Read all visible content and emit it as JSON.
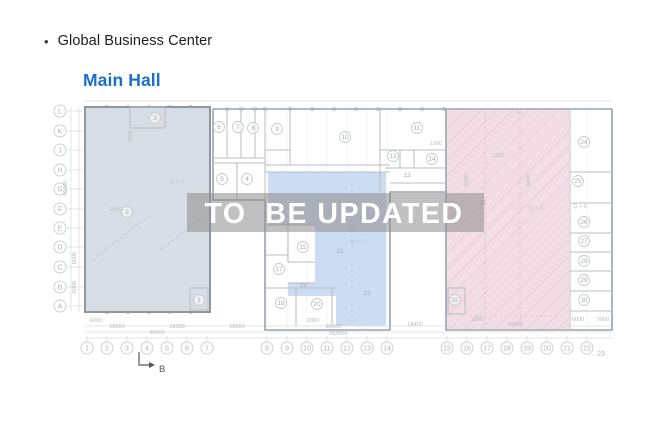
{
  "header": {
    "bullet": "•",
    "title": "Global Business Center",
    "subtitle": "Main Hall"
  },
  "watermark": {
    "text": "TO  BE UPDATED"
  },
  "colors": {
    "accent_blue": "#1a6fc7",
    "zone_left": "#d7dde4",
    "zone_middle": "#ccdcf2",
    "zone_right": "#f3dde4",
    "watermark_band": "rgba(141,141,141,0.55)",
    "watermark_text": "#ffffff"
  },
  "plan": {
    "section_marker": "B",
    "row_axes": [
      {
        "label": "L",
        "y": 111
      },
      {
        "label": "K",
        "y": 131
      },
      {
        "label": "J",
        "y": 150
      },
      {
        "label": "H",
        "y": 170
      },
      {
        "label": "G",
        "y": 189
      },
      {
        "label": "F",
        "y": 209
      },
      {
        "label": "E",
        "y": 228
      },
      {
        "label": "D",
        "y": 247
      },
      {
        "label": "C",
        "y": 267
      },
      {
        "label": "B",
        "y": 287
      },
      {
        "label": "A",
        "y": 306
      }
    ],
    "col_axes": [
      {
        "label": "1",
        "x": 87
      },
      {
        "label": "2",
        "x": 107
      },
      {
        "label": "3",
        "x": 127
      },
      {
        "label": "4",
        "x": 147
      },
      {
        "label": "5",
        "x": 167
      },
      {
        "label": "6",
        "x": 187
      },
      {
        "label": "7",
        "x": 207
      },
      {
        "label": "8",
        "x": 267
      },
      {
        "label": "9",
        "x": 287
      },
      {
        "label": "10",
        "x": 307
      },
      {
        "label": "11",
        "x": 327
      },
      {
        "label": "12",
        "x": 347
      },
      {
        "label": "13",
        "x": 367
      },
      {
        "label": "14",
        "x": 387
      },
      {
        "label": "15",
        "x": 447
      },
      {
        "label": "16",
        "x": 467
      },
      {
        "label": "17",
        "x": 487
      },
      {
        "label": "18",
        "x": 507
      },
      {
        "label": "19",
        "x": 527
      },
      {
        "label": "20",
        "x": 547
      },
      {
        "label": "21",
        "x": 567
      },
      {
        "label": "22",
        "x": 587
      },
      {
        "label": "23",
        "x": 601,
        "plain": true
      }
    ],
    "rooms": [
      {
        "n": "1",
        "x": 199,
        "y": 300
      },
      {
        "n": "2",
        "x": 127,
        "y": 212
      },
      {
        "n": "3",
        "x": 155,
        "y": 118
      },
      {
        "n": "4",
        "x": 247,
        "y": 179
      },
      {
        "n": "5",
        "x": 222,
        "y": 179
      },
      {
        "n": "6",
        "x": 219,
        "y": 127
      },
      {
        "n": "7",
        "x": 238,
        "y": 127
      },
      {
        "n": "8",
        "x": 253,
        "y": 128
      },
      {
        "n": "9",
        "x": 277,
        "y": 129
      },
      {
        "n": "10",
        "x": 345,
        "y": 137
      },
      {
        "n": "11",
        "x": 417,
        "y": 128
      },
      {
        "n": "12",
        "x": 393,
        "y": 156
      },
      {
        "n": "13",
        "x": 407,
        "y": 175,
        "plain": true
      },
      {
        "n": "14",
        "x": 432,
        "y": 159
      },
      {
        "n": "15",
        "x": 303,
        "y": 247
      },
      {
        "n": "17",
        "x": 279,
        "y": 269
      },
      {
        "n": "18",
        "x": 281,
        "y": 303
      },
      {
        "n": "19",
        "x": 303,
        "y": 285,
        "plain": true
      },
      {
        "n": "20",
        "x": 317,
        "y": 304
      },
      {
        "n": "21",
        "x": 340,
        "y": 251,
        "plain": true
      },
      {
        "n": "22",
        "x": 367,
        "y": 293,
        "plain": true
      },
      {
        "n": "24",
        "x": 584,
        "y": 142
      },
      {
        "n": "25",
        "x": 578,
        "y": 181
      },
      {
        "n": "26",
        "x": 584,
        "y": 222
      },
      {
        "n": "27",
        "x": 584,
        "y": 241
      },
      {
        "n": "28",
        "x": 584,
        "y": 261
      },
      {
        "n": "29",
        "x": 584,
        "y": 280
      },
      {
        "n": "30",
        "x": 584,
        "y": 300
      },
      {
        "n": "31",
        "x": 483,
        "y": 203,
        "plain": true
      },
      {
        "n": "32",
        "x": 455,
        "y": 300
      }
    ],
    "dims_h": [
      {
        "t": "6000",
        "x": 96,
        "y": 322
      },
      {
        "t": "18000",
        "x": 117,
        "y": 328
      },
      {
        "t": "18000",
        "x": 177,
        "y": 328
      },
      {
        "t": "36000",
        "x": 157,
        "y": 334
      },
      {
        "t": "18000",
        "x": 237,
        "y": 328
      },
      {
        "t": "2000",
        "x": 313,
        "y": 322
      },
      {
        "t": "36000",
        "x": 333,
        "y": 328
      },
      {
        "t": "153669",
        "x": 338,
        "y": 335
      },
      {
        "t": "18400",
        "x": 415,
        "y": 326
      },
      {
        "t": "1000",
        "x": 477,
        "y": 321
      },
      {
        "t": "45000",
        "x": 515,
        "y": 326
      },
      {
        "t": "6000",
        "x": 578,
        "y": 321
      },
      {
        "t": "3000",
        "x": 603,
        "y": 321
      }
    ],
    "dims_v": [
      {
        "t": "60000",
        "x": 67,
        "y": 188
      },
      {
        "t": "6000",
        "x": 76,
        "y": 258
      },
      {
        "t": "6000",
        "x": 76,
        "y": 287
      }
    ],
    "notes": [
      {
        "t": "2000",
        "x": 116,
        "y": 211
      },
      {
        "t": "Q = 3",
        "x": 177,
        "y": 183
      },
      {
        "t": "Q = 3",
        "x": 357,
        "y": 243
      },
      {
        "t": "Q = 3",
        "x": 536,
        "y": 210
      },
      {
        "t": "Q = 5",
        "x": 580,
        "y": 208
      },
      {
        "t": "23",
        "x": 518,
        "y": 113
      },
      {
        "t": "1300",
        "x": 436,
        "y": 145
      },
      {
        "t": "1900",
        "x": 498,
        "y": 157
      },
      {
        "t": "3000",
        "x": 132,
        "y": 136,
        "rot": -90
      },
      {
        "t": "6000",
        "x": 468,
        "y": 180,
        "rot": -90
      },
      {
        "t": "6000",
        "x": 530,
        "y": 180,
        "rot": -90
      }
    ]
  }
}
